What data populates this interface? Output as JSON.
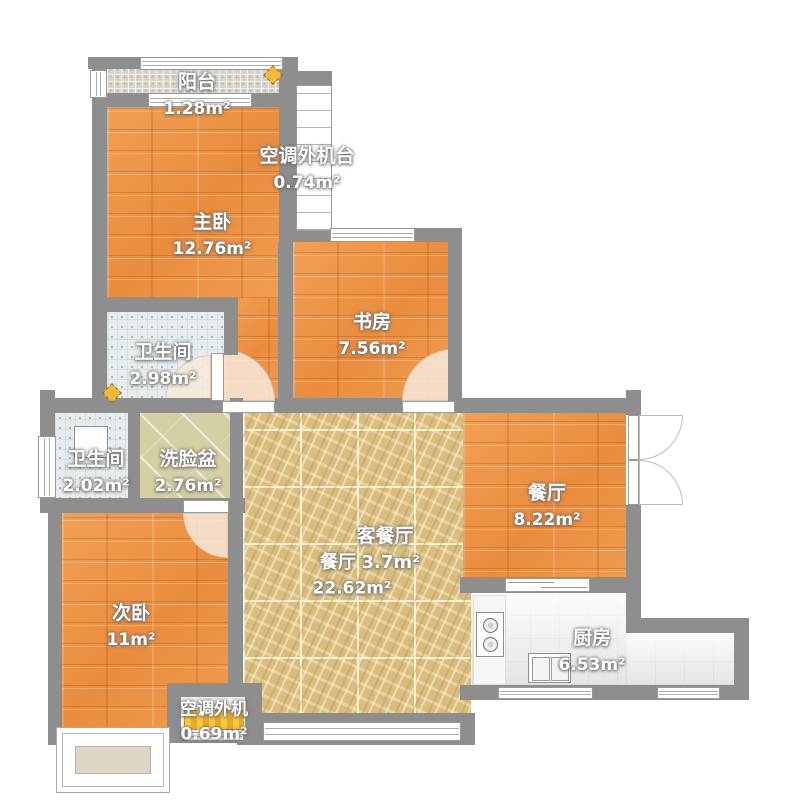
{
  "rooms": {
    "balcony": {
      "name": "阳台",
      "area": "1.28m²"
    },
    "ac_platform": {
      "name": "空调外机台",
      "area": "0.74m²"
    },
    "master_bedroom": {
      "name": "主卧",
      "area": "12.76m²"
    },
    "study": {
      "name": "书房",
      "area": "7.56m²"
    },
    "bathroom_upper": {
      "name": "卫生间",
      "area": "2.98m²"
    },
    "bathroom_lower": {
      "name": "卫生间",
      "area": "2.02m²"
    },
    "wash_basin": {
      "name": "洗脸盆",
      "area": "2.76m²"
    },
    "dining_room": {
      "name": "餐厅",
      "area": "8.22m²"
    },
    "living_dining": {
      "name": "客餐厅",
      "area": "22.62m²"
    },
    "dining_zone": {
      "name": "餐厅",
      "area": "3.7m²"
    },
    "second_bedroom": {
      "name": "次卧",
      "area": "11m²"
    },
    "kitchen": {
      "name": "厨房",
      "area": "6.53m²"
    },
    "ac_outdoor": {
      "name": "空调外机",
      "area": "0.69m²"
    }
  },
  "colors": {
    "wall": "#8e8e8e",
    "wood_floor": "#ee9548",
    "marble_floor": "#d9bd7e",
    "bath_tile": "#e7edef",
    "basin_tile": "#d5cfa4",
    "balcony_tile": "#d7d3ca",
    "kitchen_tile": "#ececec",
    "door_swing": "#f8e9db",
    "ac_unit_stripe": "#f7c841",
    "lamp_diamond": "#f3b83e",
    "label_text": "#ffffff"
  }
}
